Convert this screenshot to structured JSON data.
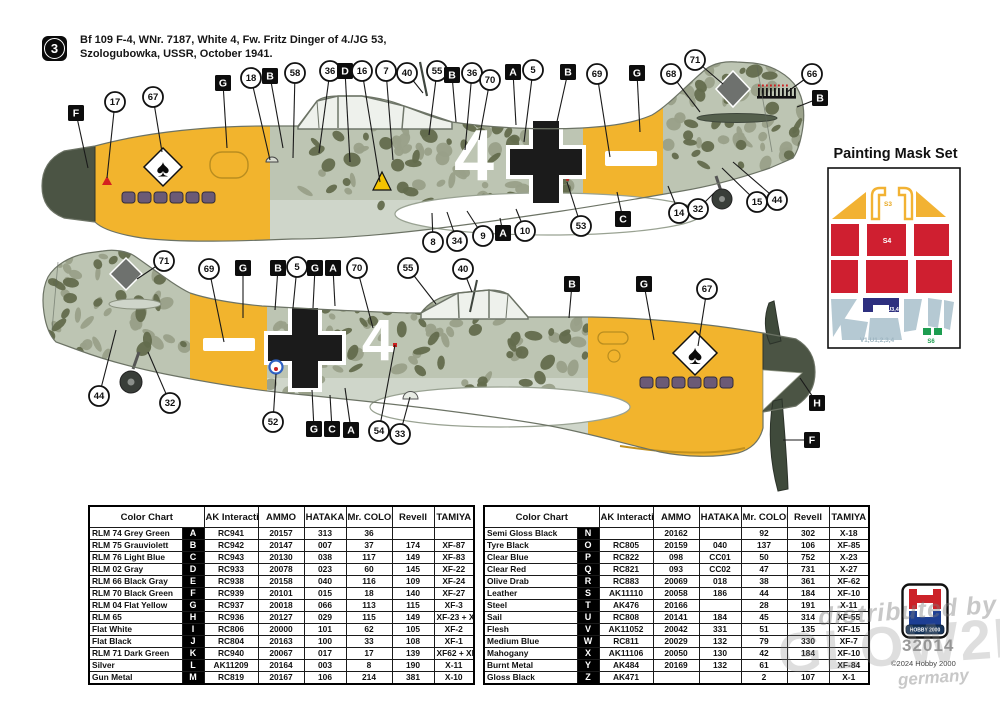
{
  "header": {
    "step_number": "3",
    "line1": "Bf 109 F-4, WNr. 7187, White 4, Fw. Fritz Dinger of 4./JG 53,",
    "line2": "Szologubowka, USSR, October 1941."
  },
  "aircraft": {
    "tactical_number": "4",
    "emblem_glyph": "♠"
  },
  "mask_set": {
    "title": "Painting Mask Set",
    "labels": {
      "canopy": "S3",
      "red": "S4",
      "navy": "U3,4",
      "blue": "V1,U1,2,3,4",
      "green": "S6"
    }
  },
  "colors": {
    "yellow": "#f2b42d",
    "spinner_dark": "#4b5444",
    "camo_base": "#bdc5b3",
    "camo_mid": "#99a089",
    "camo_dark": "#636b4d",
    "belly": "#cfd6ca",
    "cross_black": "#1b1b1b",
    "mask_red": "#cf1f30",
    "mask_yellow": "#f2b233",
    "mask_blue": "#b5c9d3",
    "mask_navy": "#2d2f7f",
    "mask_green": "#1d9d50",
    "exhaust": "#6b5a76"
  },
  "callouts": {
    "top": [
      [
        "sq",
        "F",
        76,
        113,
        88,
        168
      ],
      [
        "c",
        "17",
        115,
        102,
        107,
        178
      ],
      [
        "c",
        "67",
        153,
        97,
        162,
        152
      ],
      [
        "sq",
        "G",
        223,
        83,
        227,
        148
      ],
      [
        "c",
        "18",
        251,
        78,
        270,
        160
      ],
      [
        "sq",
        "B",
        270,
        76,
        283,
        148
      ],
      [
        "c",
        "58",
        295,
        73,
        293,
        158
      ],
      [
        "c",
        "36",
        330,
        71,
        319,
        153
      ],
      [
        "sq",
        "D",
        345,
        71,
        350,
        162
      ],
      [
        "c",
        "16",
        362,
        71,
        380,
        182
      ],
      [
        "c",
        "7",
        386,
        71,
        393,
        160
      ],
      [
        "c",
        "40",
        407,
        73,
        423,
        93
      ],
      [
        "c",
        "55",
        437,
        71,
        429,
        135
      ],
      [
        "sq",
        "B",
        452,
        75,
        456,
        122
      ],
      [
        "c",
        "36",
        472,
        73,
        465,
        150
      ],
      [
        "c",
        "70",
        490,
        80,
        479,
        140
      ],
      [
        "sq",
        "A",
        513,
        72,
        516,
        125
      ],
      [
        "c",
        "5",
        533,
        70,
        524,
        142
      ],
      [
        "sq",
        "B",
        568,
        72,
        556,
        126
      ],
      [
        "c",
        "69",
        597,
        74,
        610,
        157
      ],
      [
        "sq",
        "G",
        637,
        73,
        640,
        132
      ],
      [
        "c",
        "68",
        671,
        74,
        700,
        112
      ],
      [
        "c",
        "71",
        695,
        60,
        723,
        84
      ],
      [
        "c",
        "66",
        812,
        74,
        787,
        92
      ],
      [
        "sq",
        "B",
        820,
        98,
        797,
        107
      ],
      [
        "c",
        "8",
        433,
        242,
        432,
        213
      ],
      [
        "c",
        "34",
        457,
        241,
        447,
        212
      ],
      [
        "c",
        "9",
        483,
        236,
        467,
        211
      ],
      [
        "sq",
        "A",
        503,
        233,
        500,
        218
      ],
      [
        "c",
        "10",
        525,
        231,
        516,
        209
      ],
      [
        "c",
        "53",
        581,
        226,
        567,
        182
      ],
      [
        "sq",
        "C",
        623,
        219,
        617,
        192
      ],
      [
        "c",
        "14",
        679,
        213,
        668,
        186
      ],
      [
        "c",
        "32",
        698,
        209,
        714,
        193
      ],
      [
        "c",
        "15",
        757,
        202,
        722,
        168
      ],
      [
        "c",
        "44",
        777,
        200,
        733,
        162
      ]
    ],
    "bottom": [
      [
        "c",
        "71",
        164,
        261,
        137,
        279
      ],
      [
        "c",
        "69",
        209,
        269,
        224,
        342
      ],
      [
        "sq",
        "G",
        243,
        268,
        243,
        318
      ],
      [
        "sq",
        "B",
        278,
        268,
        275,
        310
      ],
      [
        "c",
        "5",
        297,
        267,
        293,
        308
      ],
      [
        "sq",
        "G",
        315,
        268,
        313,
        308
      ],
      [
        "sq",
        "A",
        333,
        268,
        335,
        306
      ],
      [
        "c",
        "70",
        357,
        268,
        373,
        328
      ],
      [
        "c",
        "55",
        408,
        268,
        436,
        304
      ],
      [
        "c",
        "40",
        463,
        269,
        472,
        292
      ],
      [
        "sq",
        "B",
        572,
        284,
        569,
        318
      ],
      [
        "sq",
        "G",
        644,
        284,
        654,
        340
      ],
      [
        "c",
        "67",
        707,
        289,
        698,
        346
      ],
      [
        "c",
        "44",
        99,
        396,
        116,
        330
      ],
      [
        "c",
        "32",
        170,
        403,
        148,
        352
      ],
      [
        "c",
        "52",
        273,
        422,
        276,
        374
      ],
      [
        "sq",
        "G",
        314,
        429,
        312,
        390
      ],
      [
        "sq",
        "C",
        332,
        429,
        330,
        395
      ],
      [
        "sq",
        "A",
        351,
        430,
        345,
        388
      ],
      [
        "c",
        "54",
        379,
        431,
        395,
        345
      ],
      [
        "c",
        "33",
        400,
        434,
        410,
        397
      ],
      [
        "sq",
        "H",
        817,
        403,
        800,
        378
      ],
      [
        "sq",
        "F",
        812,
        440,
        783,
        440
      ]
    ]
  },
  "color_charts": [
    {
      "headers": [
        "Color Chart",
        "AK Interactive",
        "AMMO",
        "HATAKA",
        "Mr. COLOR",
        "Revell",
        "TAMIYA"
      ],
      "rows": [
        {
          "name": "RLM 74 Grey Green",
          "code": "A",
          "values": [
            "RC941",
            "20157",
            "313",
            "36",
            "",
            ""
          ]
        },
        {
          "name": "RLM 75 Grauviolett",
          "code": "B",
          "values": [
            "RC942",
            "20147",
            "007",
            "37",
            "174",
            "XF-87"
          ]
        },
        {
          "name": "RLM 76 Light Blue",
          "code": "C",
          "values": [
            "RC943",
            "20130",
            "038",
            "117",
            "149",
            "XF-83"
          ]
        },
        {
          "name": "RLM 02 Gray",
          "code": "D",
          "values": [
            "RC933",
            "20078",
            "023",
            "60",
            "145",
            "XF-22"
          ]
        },
        {
          "name": "RLM 66 Black Gray",
          "code": "E",
          "values": [
            "RC938",
            "20158",
            "040",
            "116",
            "109",
            "XF-24"
          ]
        },
        {
          "name": "RLM 70 Black Green",
          "code": "F",
          "values": [
            "RC939",
            "20101",
            "015",
            "18",
            "140",
            "XF-27"
          ]
        },
        {
          "name": "RLM 04 Flat Yellow",
          "code": "G",
          "values": [
            "RC937",
            "20018",
            "066",
            "113",
            "115",
            "XF-3"
          ]
        },
        {
          "name": "RLM 65",
          "code": "H",
          "values": [
            "RC936",
            "20127",
            "029",
            "115",
            "149",
            "XF-23 + XF-2"
          ]
        },
        {
          "name": "Flat White",
          "code": "I",
          "values": [
            "RC806",
            "20000",
            "101",
            "62",
            "105",
            "XF-2"
          ]
        },
        {
          "name": "Flat Black",
          "code": "J",
          "values": [
            "RC804",
            "20163",
            "100",
            "33",
            "108",
            "XF-1"
          ]
        },
        {
          "name": "RLM 71 Dark Green",
          "code": "K",
          "values": [
            "RC940",
            "20067",
            "017",
            "17",
            "139",
            "XF62 + XF-49"
          ]
        },
        {
          "name": "Silver",
          "code": "L",
          "values": [
            "AK11209",
            "20164",
            "003",
            "8",
            "190",
            "X-11"
          ]
        },
        {
          "name": "Gun Metal",
          "code": "M",
          "values": [
            "RC819",
            "20167",
            "106",
            "214",
            "381",
            "X-10"
          ]
        }
      ]
    },
    {
      "headers": [
        "Color Chart",
        "AK Interactive",
        "AMMO",
        "HATAKA",
        "Mr. COLOR",
        "Revell",
        "TAMIYA"
      ],
      "rows": [
        {
          "name": "Semi Gloss Black",
          "code": "N",
          "values": [
            "",
            "20162",
            "",
            "92",
            "302",
            "X-18"
          ]
        },
        {
          "name": "Tyre Black",
          "code": "O",
          "values": [
            "RC805",
            "20159",
            "040",
            "137",
            "106",
            "XF-85"
          ]
        },
        {
          "name": "Clear Blue",
          "code": "P",
          "values": [
            "RC822",
            "098",
            "CC01",
            "50",
            "752",
            "X-23"
          ]
        },
        {
          "name": "Clear Red",
          "code": "Q",
          "values": [
            "RC821",
            "093",
            "CC02",
            "47",
            "731",
            "X-27"
          ]
        },
        {
          "name": "Olive Drab",
          "code": "R",
          "values": [
            "RC883",
            "20069",
            "018",
            "38",
            "361",
            "XF-62"
          ]
        },
        {
          "name": "Leather",
          "code": "S",
          "values": [
            "AK11110",
            "20058",
            "186",
            "44",
            "184",
            "XF-10"
          ]
        },
        {
          "name": "Steel",
          "code": "T",
          "values": [
            "AK476",
            "20166",
            "",
            "28",
            "191",
            "X-11"
          ]
        },
        {
          "name": "Sail",
          "code": "U",
          "values": [
            "RC808",
            "20141",
            "184",
            "45",
            "314",
            "XF-55"
          ]
        },
        {
          "name": "Flesh",
          "code": "V",
          "values": [
            "AK11052",
            "20042",
            "331",
            "51",
            "135",
            "XF-15"
          ]
        },
        {
          "name": "Medium Blue",
          "code": "W",
          "values": [
            "RC811",
            "20029",
            "132",
            "79",
            "330",
            "XF-7"
          ]
        },
        {
          "name": "Mahogany",
          "code": "X",
          "values": [
            "AK11106",
            "20050",
            "130",
            "42",
            "184",
            "XF-10"
          ]
        },
        {
          "name": "Burnt Metal",
          "code": "Y",
          "values": [
            "AK484",
            "20169",
            "132",
            "61",
            "",
            "XF-84"
          ]
        },
        {
          "name": "Gloss Black",
          "code": "Z",
          "values": [
            "AK471",
            "",
            "",
            "2",
            "107",
            "X-1"
          ]
        }
      ]
    }
  ],
  "footer": {
    "logo_text": "HOBBY 2000",
    "kit_number": "32014",
    "copyright": "©2024 Hobby 2000",
    "watermark_line1": "distributed by",
    "watermark_word": "GLOW2B",
    "watermark_country": "germany"
  }
}
